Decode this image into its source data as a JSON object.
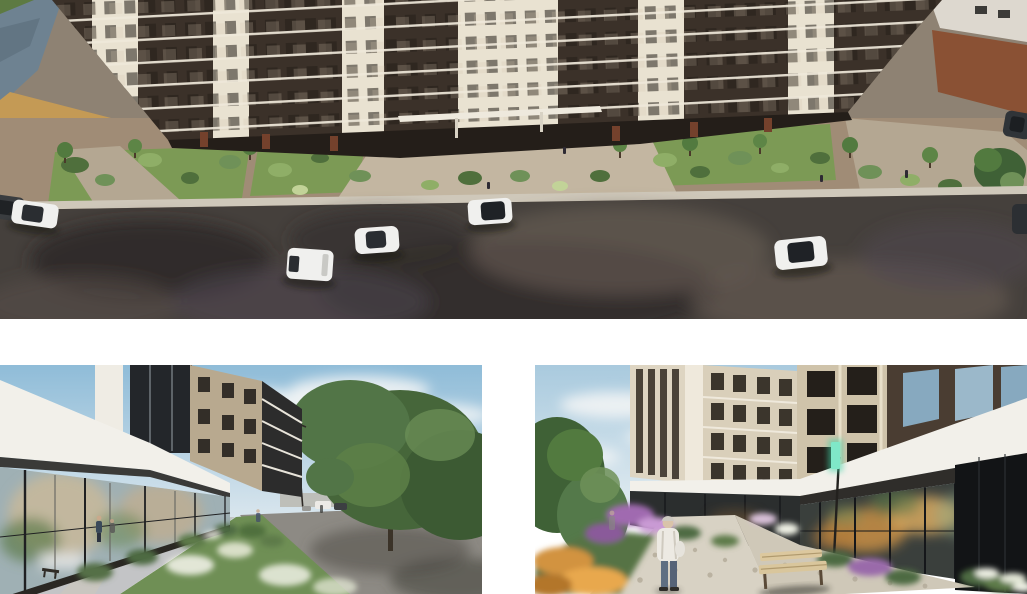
{
  "page": {
    "title": "Residential complex renders",
    "background": "#ffffff"
  },
  "palette": {
    "page-bg": "#ffffff",
    "facade-dark": "#3b3129",
    "facade-cream": "#e9e2d1",
    "slab-light": "#efe9da",
    "ground-floor-dark": "#241e19",
    "grass": "#7c9a55",
    "bush-dark": "#4f6f3c",
    "bush-light": "#8fae67",
    "pavement": "#a08c76",
    "plaza-light": "#c3b6a1",
    "sidewalk": "#cfc8ba",
    "asphalt": "#45403c",
    "asphalt-dark": "#2b2725",
    "asphalt-light": "#6b5f57",
    "water": "#6e8291",
    "sky-top": "#8fbcd8",
    "sky-horizon": "#dfe9ef",
    "cloud": "#f4f6f6",
    "tree-dark": "#3f6136",
    "tree-light": "#6f9158",
    "canopy-white": "#f2f0ea",
    "glass-cool": "#9fb0b4",
    "glass-dark": "#17191c",
    "interior-warm": "#c98f45",
    "path-stone": "#d8d2c4",
    "flower-purple": "#a06ab0",
    "flower-orange": "#d2933f",
    "flower-white": "#eef0e4",
    "car-white": "#f0f0ee",
    "car-dark": "#33373b",
    "brick-wall": "#8a5134",
    "tan-wall": "#c49a55",
    "person-jacket": "#edeae3"
  },
  "gallery": {
    "layout": "one wide render on top, two renders below separated by white gaps",
    "images": [
      {
        "id": "render-aerial-facade",
        "description": "Elevated view of a modern residential complex facade with alternating dark-brown and cream sections, landscaped front gardens, a sidewalk, and a wet asphalt street with parked white and dark cars; pond at upper left, neighbouring buildings at upper right.",
        "elements": [
          "apartment building facade",
          "ground-floor storefronts",
          "entrance canopy",
          "front gardens with bushes and trees",
          "sidewalk",
          "street",
          "parked cars",
          "pond",
          "neighbouring buildings"
        ]
      },
      {
        "id": "render-street-view",
        "description": "Street-level view along the building: white canopy over a glass storefront reflecting an older building, upper floors with balconies, paved promenade with lawns and white flower beds, large green trees, a street lamp, distant cars and pedestrians under a blue sky with clouds.",
        "elements": [
          "glass storefront",
          "white canopy",
          "balconies",
          "promenade path",
          "lawn and flower beds",
          "large trees",
          "street lamp",
          "pedestrians",
          "distant cars",
          "sky with clouds"
        ]
      },
      {
        "id": "render-courtyard-view",
        "description": "Courtyard view of the residence entrance: cream towers with recessed balconies, white fascia over ground-floor glazing with warm interior light, teal entrance sign, stone path with a person in a white jacket, flower beds in purple, orange and white, a wooden bench, trees on the left and a dark glass wall on the right.",
        "elements": [
          "cream towers",
          "white fascia",
          "glass storefront with warm light",
          "teal entrance sign",
          "stone path",
          "person in white jacket",
          "flower beds",
          "wooden bench",
          "trees",
          "dark glass wall"
        ]
      }
    ]
  }
}
